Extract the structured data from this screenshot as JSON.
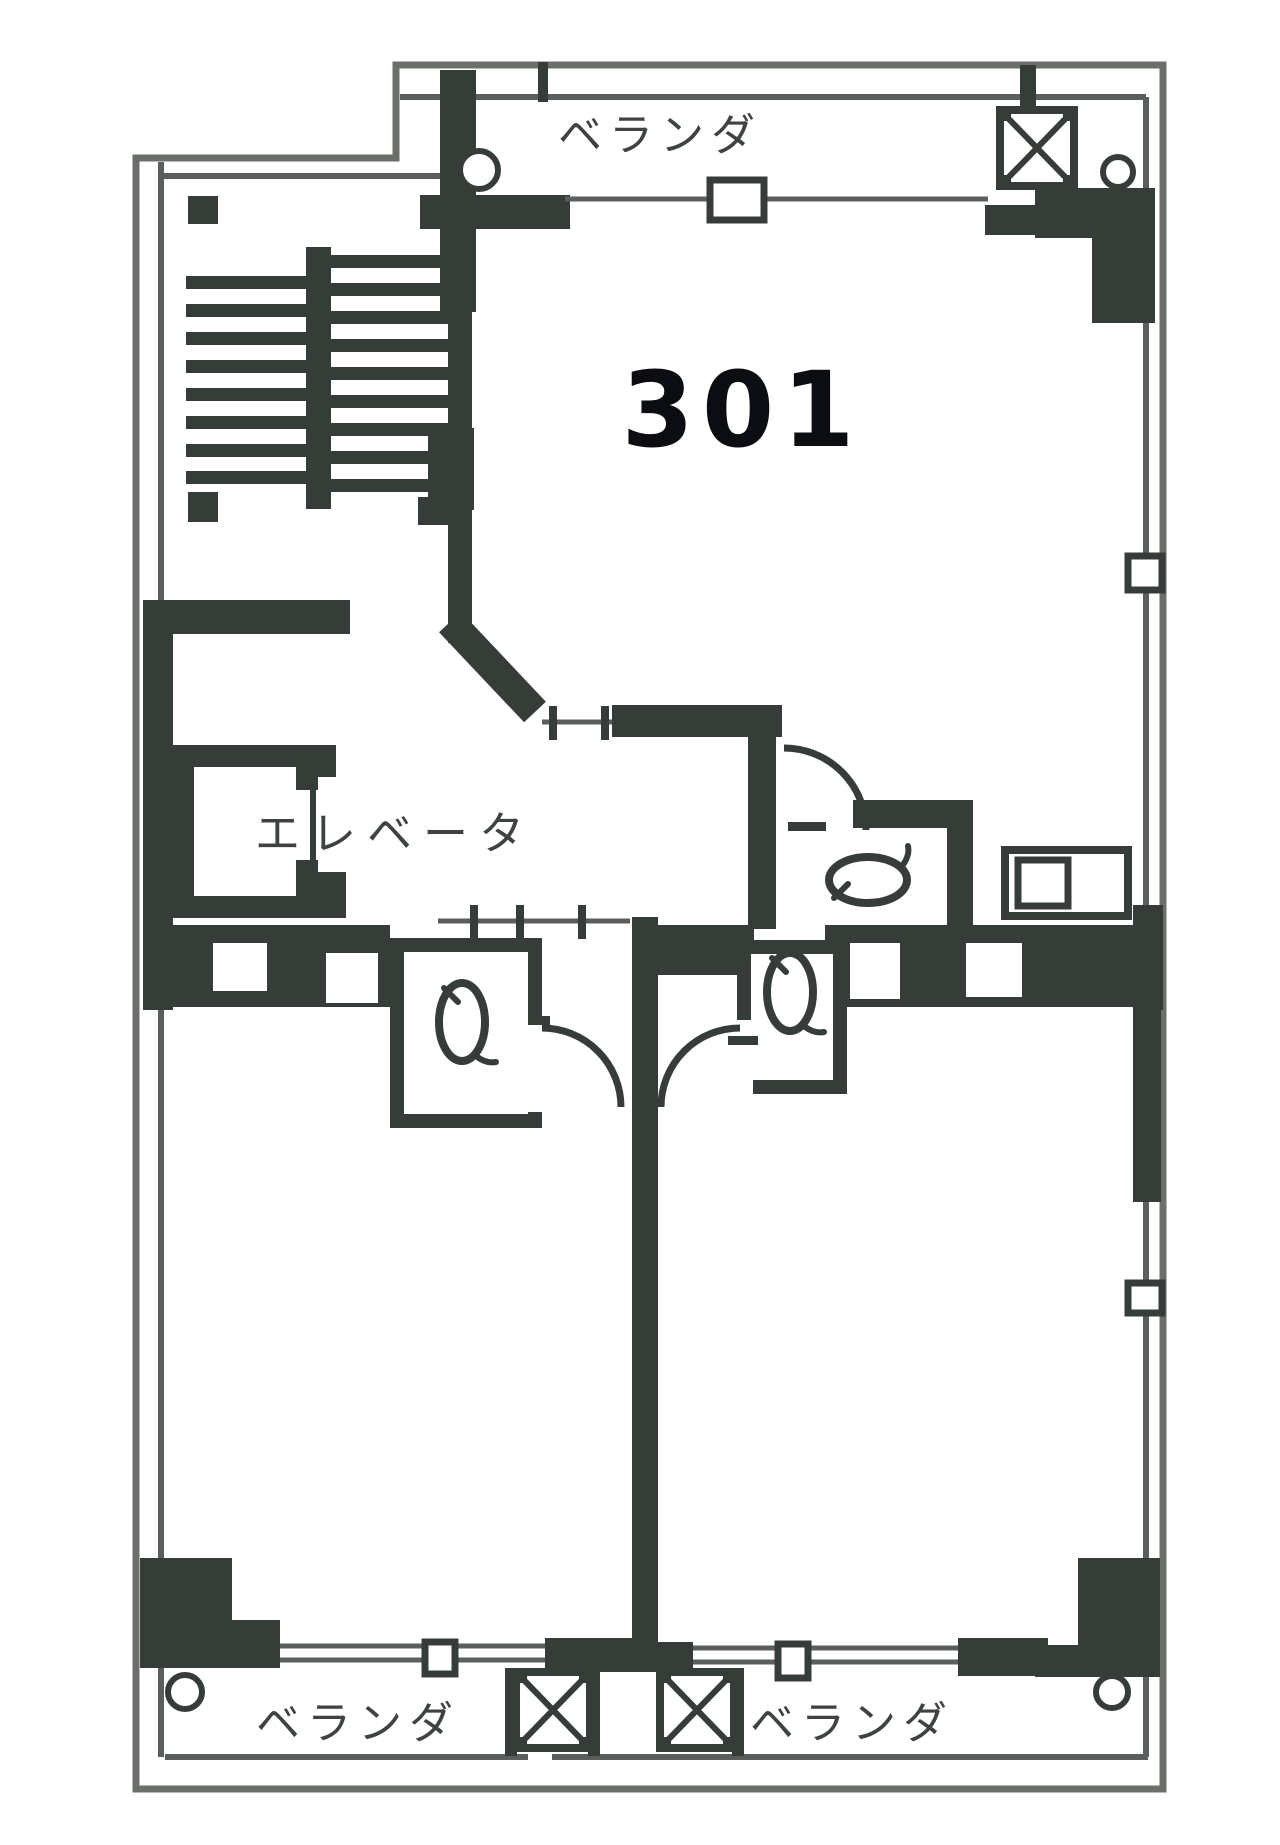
{
  "floor_plan": {
    "unit_number": "301",
    "rooms": {
      "veranda_top": "ベランダ",
      "veranda_bottom_left": "ベランダ",
      "veranda_bottom_right": "ベランダ",
      "elevator": "エレベータ"
    },
    "symbols": [
      "stairs",
      "elevator-shaft",
      "toilet",
      "duct-shaft-x-box",
      "door-swing-arc",
      "window",
      "drain-circle"
    ]
  },
  "colors": {
    "wall": "#363c38",
    "line": "#5a5f5b",
    "outline": "#6a6f6a",
    "bg": "#ffffff",
    "label": "#3e4340",
    "number": "#0b0d12"
  }
}
